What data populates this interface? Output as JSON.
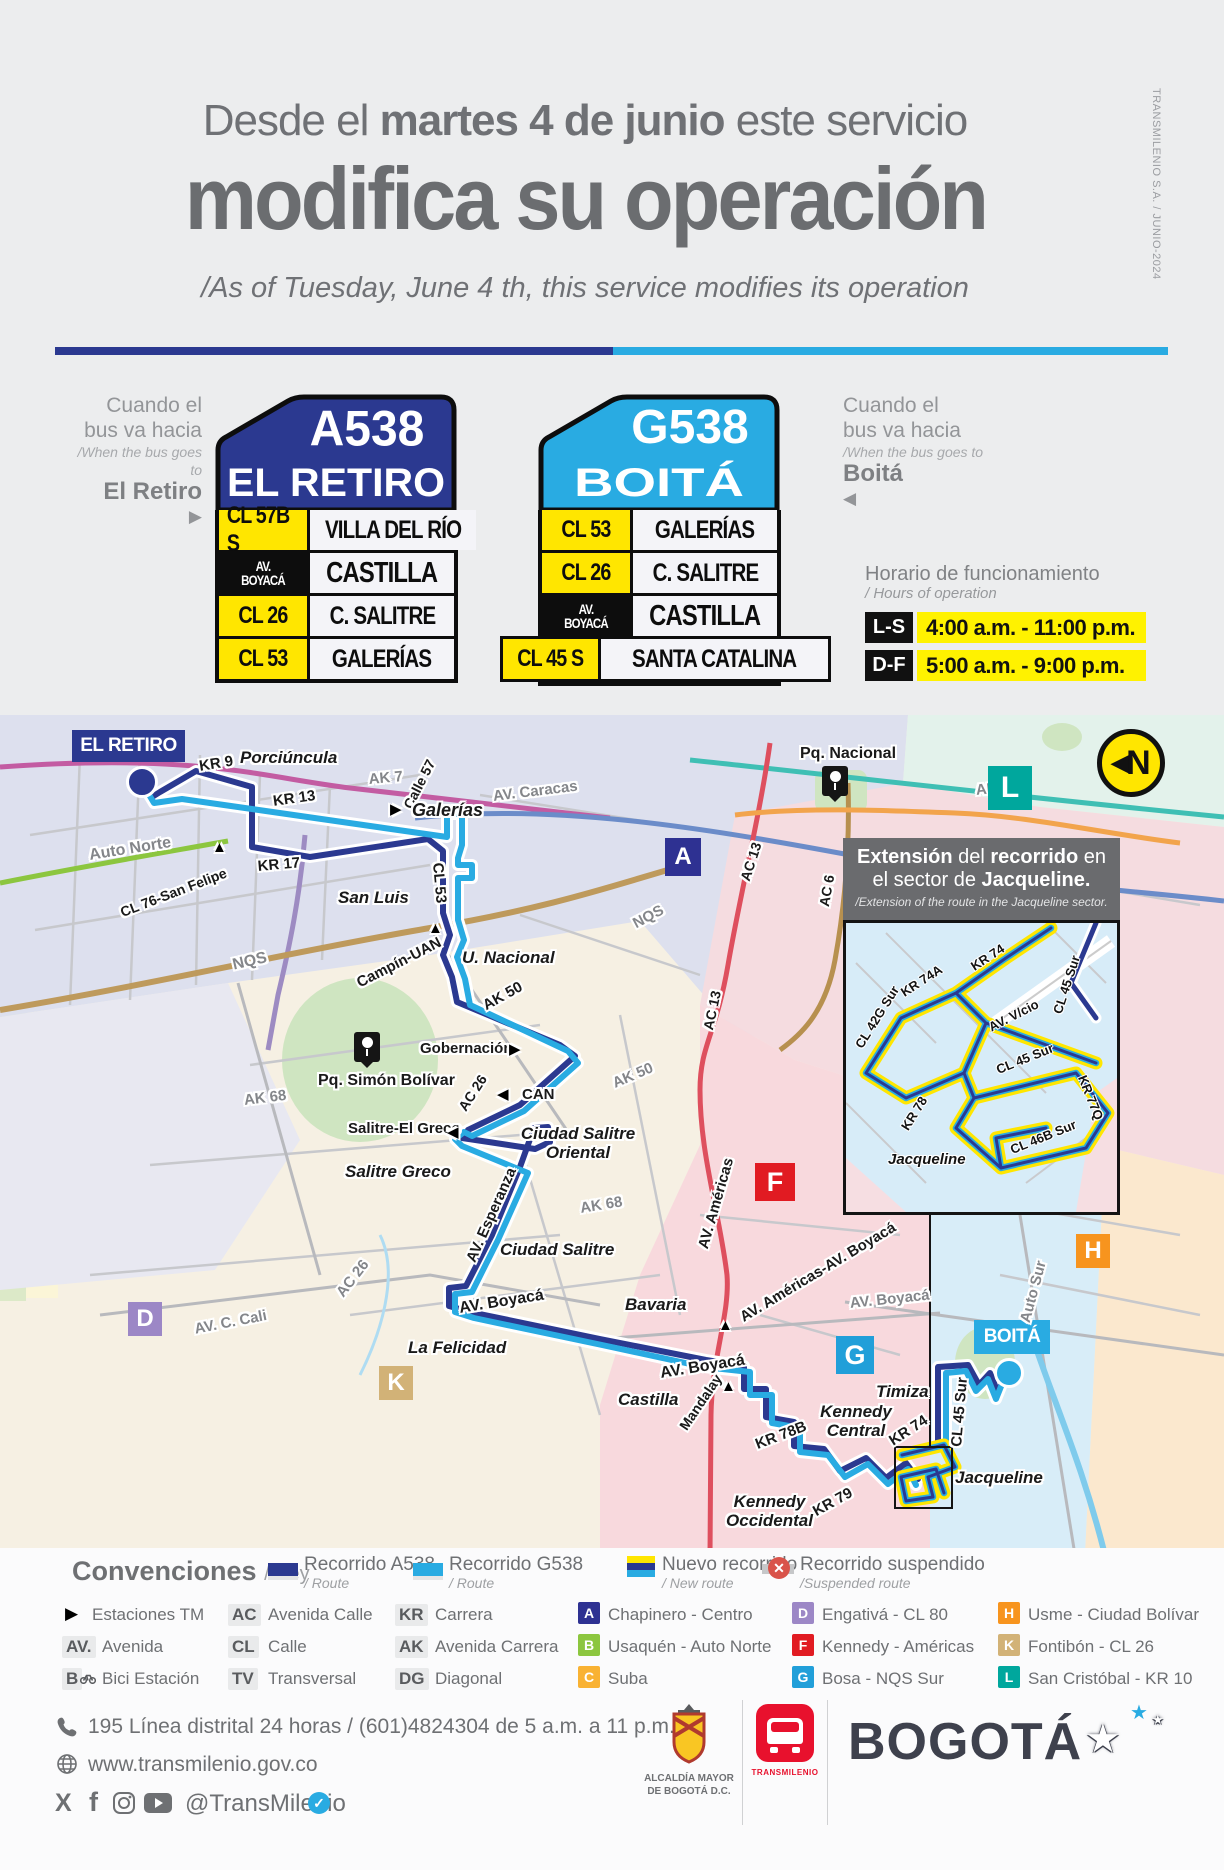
{
  "edition": "TRANSMILENIO S.A. / JUNIO-2024",
  "header": {
    "line1_pre": "Desde el ",
    "line1_bold": "martes 4 de junio",
    "line1_post": " este servicio",
    "line2": "modifica su operación",
    "line3": "/As of Tuesday, June 4 th, this service modifies its operation"
  },
  "signs": {
    "a538": {
      "direction": {
        "l1": "Cuando el",
        "l2": "bus va hacia",
        "l3": "/When the bus goes to",
        "dest": "El Retiro",
        "arrow": "▶"
      },
      "code": "A538",
      "name": "EL RETIRO",
      "rows": [
        {
          "code": "CL 57B S",
          "stop": "VILLA DEL RÍO"
        },
        {
          "code": "AV. BOYACÁ",
          "stop": "CASTILLA"
        },
        {
          "code": "CL 26",
          "stop": "C. SALITRE"
        },
        {
          "code": "CL 53",
          "stop": "GALERÍAS"
        }
      ]
    },
    "g538": {
      "direction": {
        "l1": "Cuando el",
        "l2": "bus va hacia",
        "l3": "/When the bus goes to",
        "dest": "Boitá",
        "arrow": "◀"
      },
      "code": "G538",
      "name": "BOITÁ",
      "rows": [
        {
          "code": "CL 53",
          "stop": "GALERÍAS"
        },
        {
          "code": "CL 26",
          "stop": "C. SALITRE"
        },
        {
          "code": "AV. BOYACÁ",
          "stop": "CASTILLA"
        },
        {
          "code": "CL 45 S",
          "stop": "SANTA CATALINA"
        }
      ]
    }
  },
  "hours": {
    "title": "Horario de funcionamiento",
    "subtitle": "/ Hours of operation",
    "rows": [
      {
        "days": "L-S",
        "time": "4:00 a.m. - 11:00 p.m."
      },
      {
        "days": "D-F",
        "time": "5:00 a.m. - 9:00 p.m."
      }
    ]
  },
  "map": {
    "terminus_a": "EL RETIRO",
    "terminus_b": "BOITÁ",
    "compass_arrow": "◀",
    "compass_letter": "N",
    "labels": [
      "Porciúncula",
      "KR 9",
      "KR 13",
      "AK 7",
      "Calle 57",
      "Galerías",
      "AV. Caracas",
      "Auto Norte",
      "CL 76-San Felipe",
      "KR 17",
      "San Luis",
      "CL 53",
      "NQS",
      "Campín-UAN",
      "U. Nacional",
      "AK 50",
      "Pq. Simón Bolívar",
      "Gobernación",
      "AC 26",
      "CAN",
      "AK 68",
      "AK 50",
      "Salitre-El Greco",
      "Ciudad Salitre Oriental",
      "Salitre Greco",
      "AV. Esperanza",
      "AK 68",
      "Ciudad Salitre",
      "AC 26",
      "AV. C. Cali",
      "AV. Boyacá",
      "La Felicidad",
      "Bavaria",
      "AV. Américas",
      "AV. Américas-AV. Boyacá",
      "AV. Boyacá",
      "AV. Boyacá",
      "Castilla",
      "Mandalay",
      "KR 78B",
      "Kennedy Central",
      "KR 74",
      "Timiza",
      "CL 45 Sur",
      "Jacqueline",
      "Kennedy Occidental",
      "KR 79",
      "Auto Sur",
      "Pq. Nacional",
      "AK 10",
      "AC 13",
      "AC 6",
      "AC 13",
      "NQS"
    ],
    "stations": [
      "▶",
      "▲",
      "▲",
      "▶",
      "◀",
      "◀",
      "▲",
      "▲"
    ],
    "zone_markers": [
      {
        "letter": "A"
      },
      {
        "letter": "D"
      },
      {
        "letter": "F"
      },
      {
        "letter": "G"
      },
      {
        "letter": "H"
      },
      {
        "letter": "K"
      },
      {
        "letter": "L"
      }
    ],
    "inset": {
      "t1a": "Extensión",
      "t1b": " del ",
      "t1c": "recorrido",
      "t1d": " en",
      "t2a": "el sector de ",
      "t2b": "Jacqueline.",
      "subtitle": "/Extension of the route in the Jacqueline sector.",
      "labels": [
        "KR 74",
        "CL 45 Sur",
        "KR 74A",
        "CL 42G Sur",
        "AV. V/cio",
        "KR 78",
        "CL 45 Sur",
        "KR 77Q",
        "CL 46B Sur",
        "Jacqueline"
      ]
    }
  },
  "legend": {
    "title": "Convenciones",
    "title_sub": "/ Key",
    "routes": [
      {
        "label": "Recorrido A538",
        "sub": "/ Route",
        "color": "#2B3990"
      },
      {
        "label": "Recorrido G538",
        "sub": "/ Route",
        "color": "#29ABE2"
      },
      {
        "label": "Nuevo recorrido",
        "sub": "/ New route",
        "colors": [
          "#FFE600",
          "#2B3990",
          "#29ABE2"
        ]
      },
      {
        "label": "Recorrido suspendido",
        "sub": "/Suspended route",
        "color": "#B9BABE"
      }
    ],
    "abbreviations": [
      {
        "label": "Estaciones TM"
      },
      {
        "code": "AV.",
        "label": "Avenida"
      },
      {
        "code": "B",
        "label": "Bici Estación"
      },
      {
        "code": "AC",
        "label": "Avenida Calle"
      },
      {
        "code": "CL",
        "label": "Calle"
      },
      {
        "code": "TV",
        "label": "Transversal"
      },
      {
        "code": "KR",
        "label": "Carrera"
      },
      {
        "code": "AK",
        "label": "Avenida Carrera"
      },
      {
        "code": "DG",
        "label": "Diagonal"
      }
    ],
    "zones": [
      {
        "letter": "A",
        "label": "Chapinero - Centro",
        "color": "#2E3192"
      },
      {
        "letter": "B",
        "label": "Usaquén - Auto Norte",
        "color": "#8CC63F"
      },
      {
        "letter": "C",
        "label": "Suba",
        "color": "#F9B233"
      },
      {
        "letter": "D",
        "label": "Engativá - CL 80",
        "color": "#9C87C6"
      },
      {
        "letter": "F",
        "label": "Kennedy - Américas",
        "color": "#E11B22"
      },
      {
        "letter": "G",
        "label": "Bosa - NQS Sur",
        "color": "#219FD9"
      },
      {
        "letter": "H",
        "label": "Usme - Ciudad Bolívar",
        "color": "#F7941E"
      },
      {
        "letter": "K",
        "label": "Fontibón - CL 26",
        "color": "#D2B277"
      },
      {
        "letter": "L",
        "label": "San Cristóbal - KR 10",
        "color": "#00A79D"
      }
    ]
  },
  "footer": {
    "phone": "195 Línea distrital 24 horas / (601)4824304 de 5 a.m. a 11 p.m.",
    "website": "www.transmilenio.gov.co",
    "social_handle": "@TransMilenio",
    "logos": {
      "alcaldia_l1": "ALCALDÍA MAYOR",
      "alcaldia_l2": "DE BOGOTÁ D.C.",
      "transmilenio": "TRANSMILENIO",
      "bogota": "BOGOTÁ"
    }
  }
}
